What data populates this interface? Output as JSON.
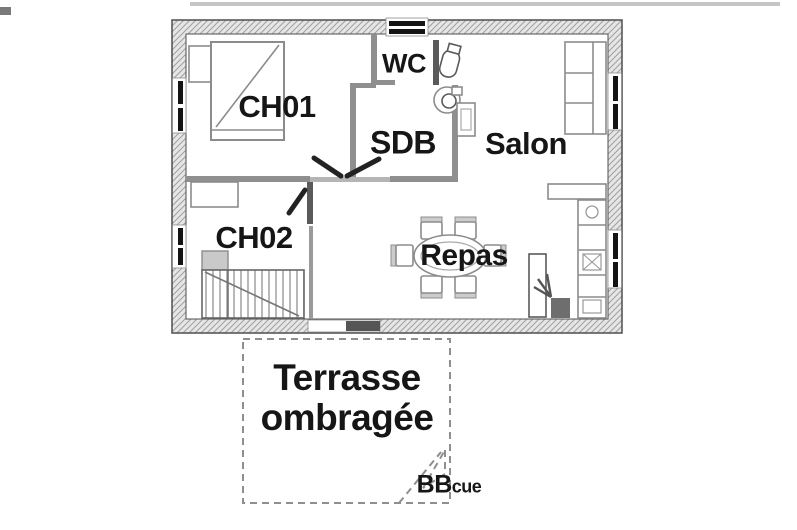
{
  "image_type": "floor-plan",
  "colors": {
    "wall_edge": "#4f4f4f",
    "wall_fill": "#e6e6e6",
    "wall_hatch": "#a3a3a3",
    "wall_inner": "#8f8f8f",
    "threshold": "#b5b5b5",
    "furniture": "#8c8c8c",
    "furniture_dark": "#5a5a5a",
    "door_leaf": "#222222",
    "text": "#161616",
    "dash": "#8f8f8f"
  },
  "rooms": {
    "ch01": "CH01",
    "ch02": "CH02",
    "sdb": "SDB",
    "wc": "WC",
    "salon": "Salon",
    "repas": "Repas"
  },
  "terrace": {
    "line1": "Terrasse",
    "line2": "ombragée"
  },
  "bbq": {
    "big": "BB",
    "small": "cue"
  }
}
